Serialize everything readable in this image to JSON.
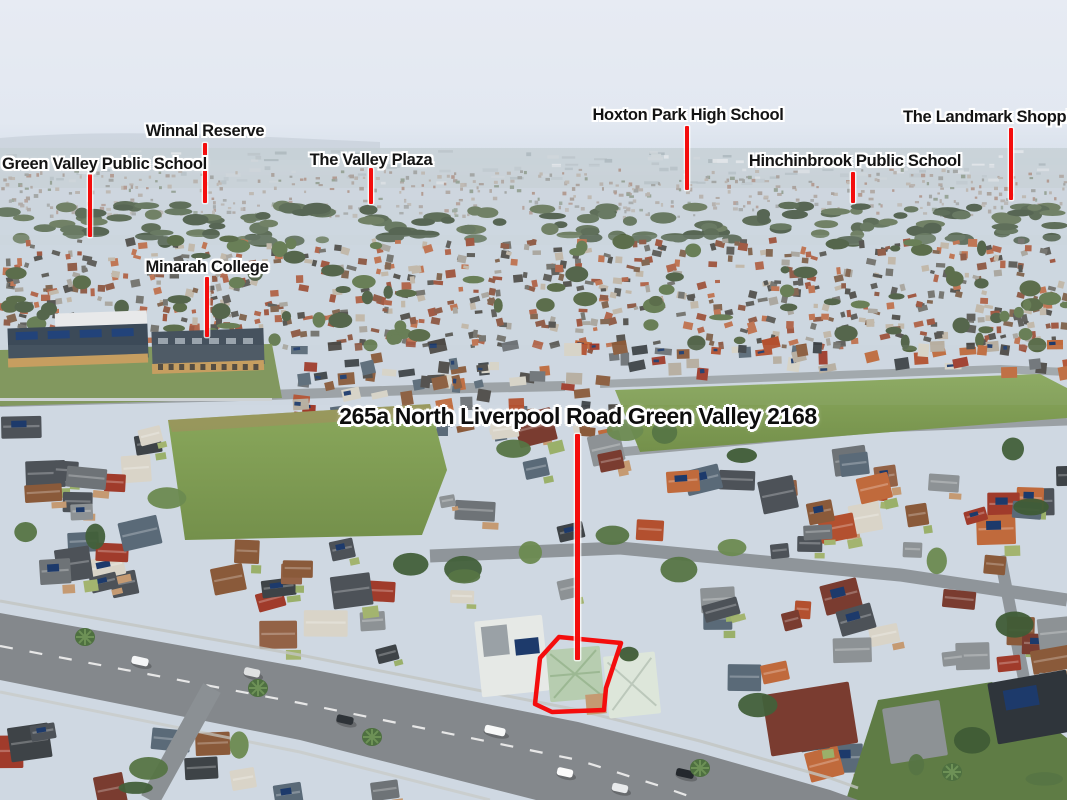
{
  "image": {
    "kind": "annotated aerial photograph",
    "location": "Green Valley NSW 2168 suburb, aerial view"
  },
  "property": {
    "title": "265a North Liverpool Road Green Valley 2168",
    "outline_points": "559,637 621,643 606,688 604,710 552,712 535,704 540,658"
  },
  "labels": [
    {
      "text": "Green Valley Public School"
    },
    {
      "text": "Winnal Reserve"
    },
    {
      "text": "The Valley Plaza"
    },
    {
      "text": "Hoxton Park High School"
    },
    {
      "text": "Hinchinbrook Public School"
    },
    {
      "text": "The Landmark Shopping"
    },
    {
      "text": "Minarah College"
    }
  ],
  "colors": {
    "marker_red": "#f40d0d",
    "label_text": "#141414",
    "label_halo": "#ffffff",
    "sky": "#e9edf4"
  }
}
